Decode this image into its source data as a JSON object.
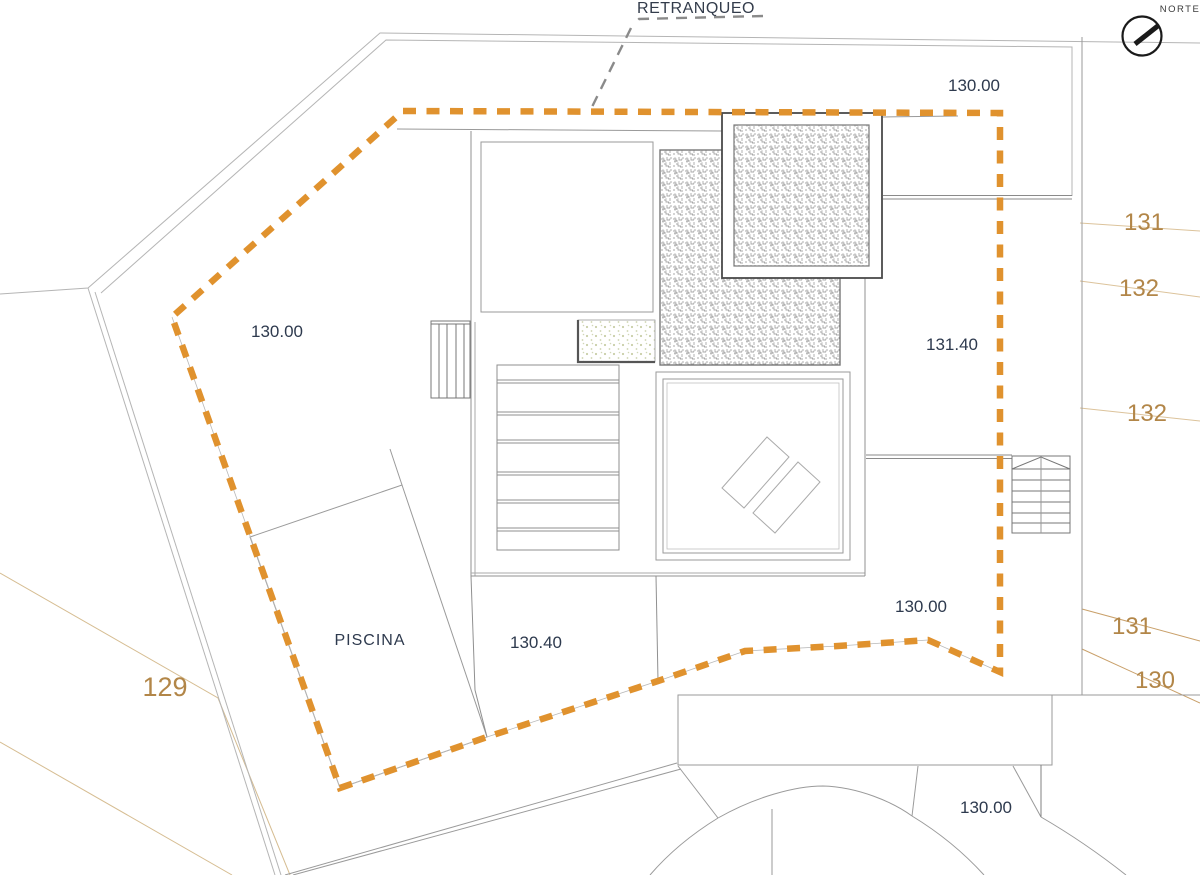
{
  "annotations": {
    "retranqueo": "RETRANQUEO",
    "norte": "NORTE"
  },
  "elevations": {
    "plot_top_right": "130.00",
    "plot_left": "130.00",
    "terrace_upper": "131.40",
    "terrace_lower": "130.00",
    "pool_deck": "130.40",
    "pool": "PISCINA",
    "driveway": "130.00"
  },
  "contours": {
    "right_top_1": "131",
    "right_top_2": "132",
    "right_mid": "132",
    "left": "129",
    "right_bottom_1": "131",
    "right_bottom_2": "130"
  },
  "colors": {
    "setback_dash": "#E0922E",
    "contour_line_light": "#DCC39B",
    "contour_line_dark": "#C9A06A",
    "contour_label": "#B28648",
    "elevation_label": "#2E3A4E",
    "drawing_line": "#909090",
    "plot_line": "#B5B5B5"
  }
}
